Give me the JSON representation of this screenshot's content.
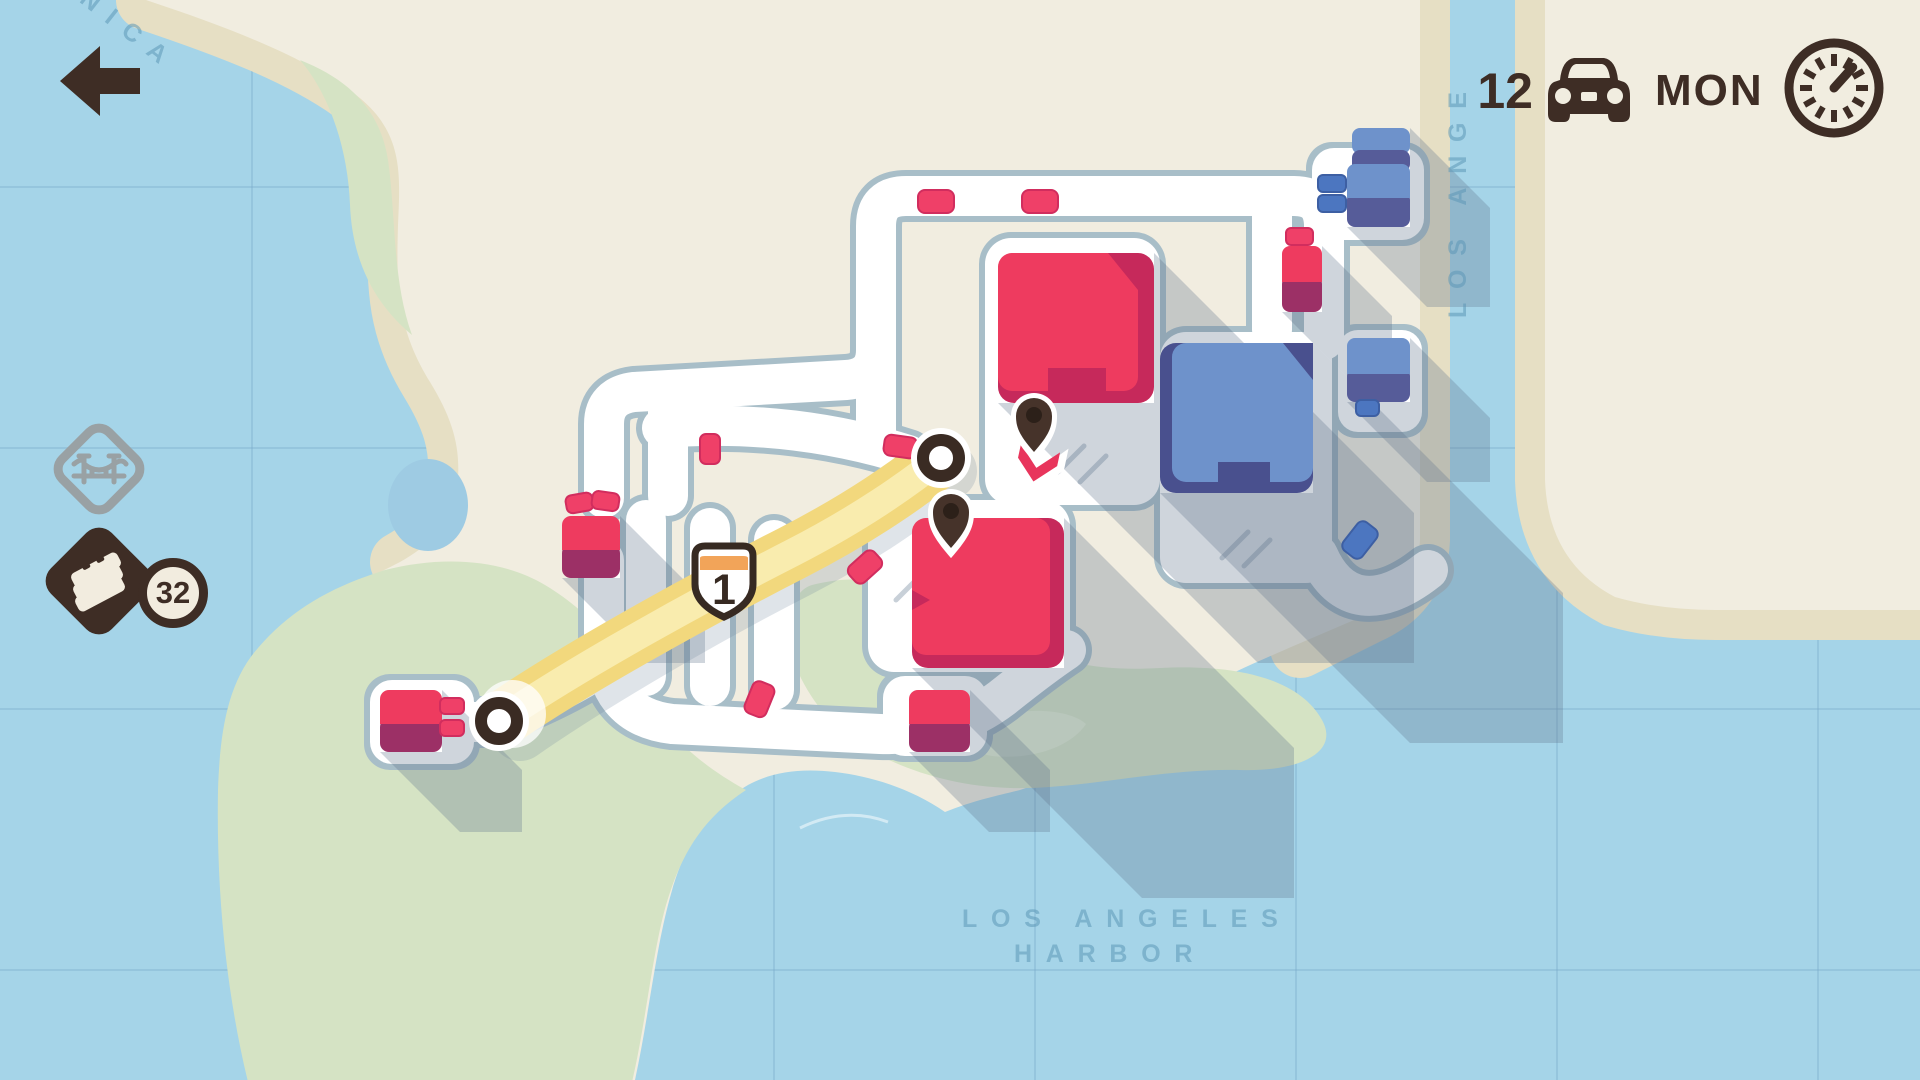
{
  "hud": {
    "vehicle_count": "12",
    "day": "MON",
    "icons": [
      "back-arrow-icon",
      "car-icon",
      "clock-icon"
    ]
  },
  "inventory": {
    "bridge_icon": "bridge-icon",
    "road_tiles_icon": "road-tiles-icon",
    "road_tiles_count": "32"
  },
  "map_labels": {
    "harbor_line1": "LOS ANGELES",
    "harbor_line2": "HARBOR",
    "river": "LOS ANGE",
    "coast": "NICA"
  },
  "highway": {
    "shield_number": "1"
  },
  "colors": {
    "water": "#a5d4e8",
    "land": "#f1ede0",
    "sand": "#e6dfc4",
    "park": "#d5e3c4",
    "road_casing": "#a8bec8",
    "red_building": "#ee3b5f",
    "red_dark": "#c6295b",
    "magenta_house": "#9c3066",
    "blue_building": "#6e92cb",
    "blue_dark": "#49508e",
    "ui_dark": "#3e2d25",
    "highway_yellow": "#f2d87d",
    "highway_light": "#f9ecae",
    "shield_orange": "#f2a459",
    "icon_gray": "#99a1a4"
  }
}
